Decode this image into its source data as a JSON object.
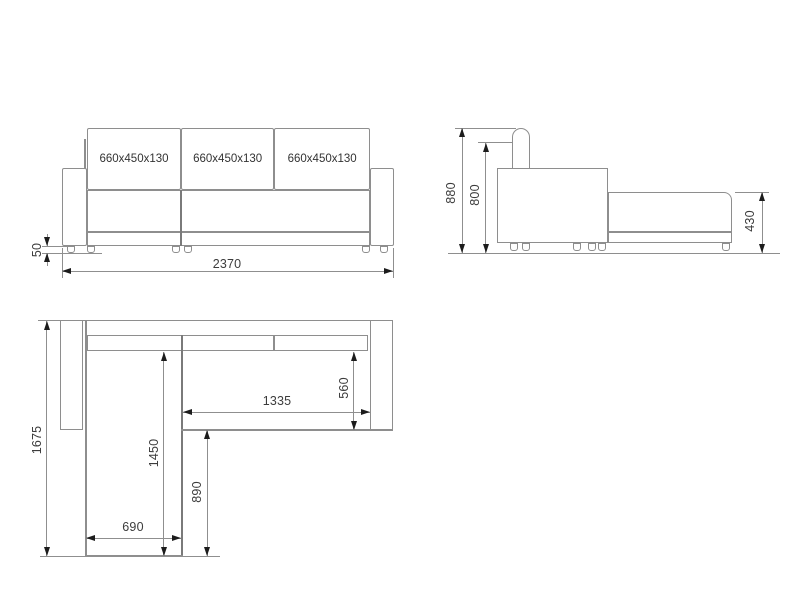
{
  "front_view": {
    "cushion_labels": [
      "660x450x130",
      "660x450x130",
      "660x450x130"
    ],
    "dimensions": {
      "overall_width": "2370",
      "leg_height": "50"
    }
  },
  "side_view": {
    "dimensions": {
      "overall_height": "880",
      "backrest_height": "800",
      "seat_height": "430"
    }
  },
  "top_view": {
    "dimensions": {
      "overall_depth": "1675",
      "chaise_length": "1450",
      "chaise_front_length": "890",
      "chaise_width": "690",
      "seat_width": "1335",
      "seat_depth": "560"
    }
  },
  "colors": {
    "background": "#ffffff",
    "outline": "#8e8e8e",
    "dimension_line": "#8f8f8f",
    "arrow": "#1c1c1c",
    "text": "#3c3c3c"
  }
}
